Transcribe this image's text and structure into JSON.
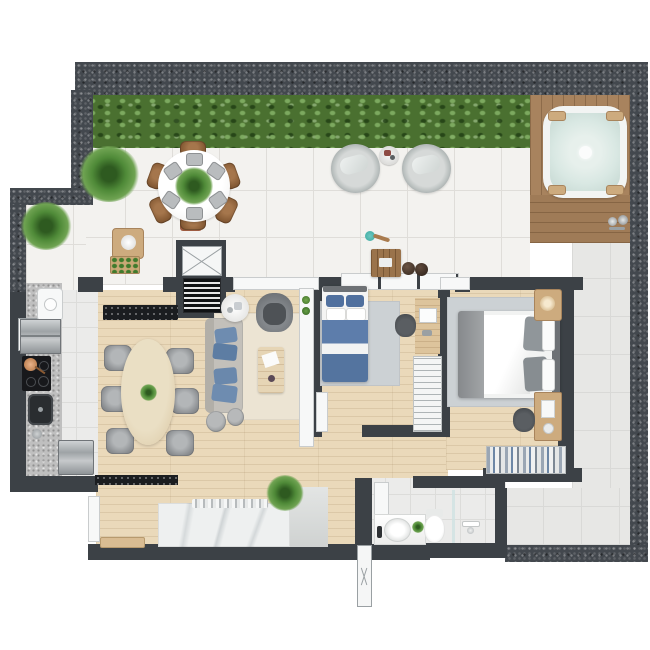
{
  "meta": {
    "title": "Apartment floor plan – top-down 3D render",
    "canvas_width": 650,
    "canvas_height": 650,
    "visible_text": "none"
  },
  "palette": {
    "wall_dark": "#3c4146",
    "wall_speckle": "#43484e",
    "tile_terrace": "#f3f2ef",
    "tile_interior": "#ebebea",
    "tile_exterior": "#e7e7e5",
    "floor_wood": "#ead9ba",
    "deck_wood": "#a8835e",
    "hedge_green": "#4a7030",
    "water_aqua": "#d9e8e3",
    "rug_cream": "#ece4d3",
    "rug_gray": "#ccd1d4",
    "sofa_gray": "#c3c0ba",
    "pillow_blue": "#6e8cb0",
    "bed_blue": "#5d7dab",
    "bed_gray": "#90969a",
    "counter_black": "#1b1d20",
    "counter_granite": "#bfbfbf",
    "marble_white": "#eef0f0",
    "steel_gray": "#aeb3b6",
    "chair_wood_brown": "#855a34",
    "chair_gray": "#8d9093",
    "plant_green": "#4f8a38",
    "teal_accent": "#3aa9a0",
    "terracotta": "#9e5b40"
  },
  "rooms": [
    {
      "id": "terrace",
      "label": "roof terrace with hedge, dining set, lounge chairs and deck"
    },
    {
      "id": "spa-deck",
      "label": "wooden deck with hot tub and outdoor shower"
    },
    {
      "id": "living-dining",
      "label": "living and dining room"
    },
    {
      "id": "kitchen",
      "label": "linear kitchen with laundry"
    },
    {
      "id": "bedroom-1",
      "label": "single bedroom"
    },
    {
      "id": "bedroom-master",
      "label": "master bedroom"
    },
    {
      "id": "bathroom",
      "label": "bathroom with shower"
    },
    {
      "id": "hallway",
      "label": "internal corridor"
    },
    {
      "id": "exterior-walkway",
      "label": "external tiled walkway"
    }
  ],
  "furniture": {
    "terrace": [
      "privacy hedge",
      "potted plant x2",
      "round dining table for six",
      "wooden dining chairs x6",
      "green centerpiece",
      "side bench with vase",
      "crate of herbs",
      "papasan lounge chairs x2",
      "small drinks table",
      "square wooden coffee table",
      "dark poufs x2",
      "terracotta planter"
    ],
    "spa-deck": [
      "square hot tub with aqua water",
      "outdoor shower fitting"
    ],
    "living-dining": [
      "oval wooden dining table",
      "rattan chairs x6",
      "three-seat sofa with blue cushions",
      "round side table",
      "swivel armchair",
      "cream rug",
      "wooden coffee table",
      "gray poufs x2",
      "white media sideboard with plants",
      "black granite counter",
      "kitchen island with marble top and bar bottles",
      "low wooden bench"
    ],
    "kitchen": [
      "laundry cabinet",
      "laundry sink",
      "refrigerator",
      "cooktop with pan",
      "black sink",
      "steel cabinet",
      "granite worktop"
    ],
    "bedroom-1": [
      "single bed with blue bedding",
      "gray rug",
      "desk with laptop",
      "desk chair",
      "slatted wardrobe",
      "open door leaf"
    ],
    "bedroom-master": [
      "double bed with gray and white bedding",
      "gray rug",
      "nightstand with lamp",
      "vanity desk",
      "chair",
      "open wardrobe with hanging clothes"
    ],
    "bathroom": [
      "white door panel",
      "wall shelf",
      "vanity with round basin",
      "small plant",
      "toilet",
      "shower fitting",
      "glass divider"
    ],
    "core": [
      "elevator shaft",
      "staircase"
    ]
  }
}
